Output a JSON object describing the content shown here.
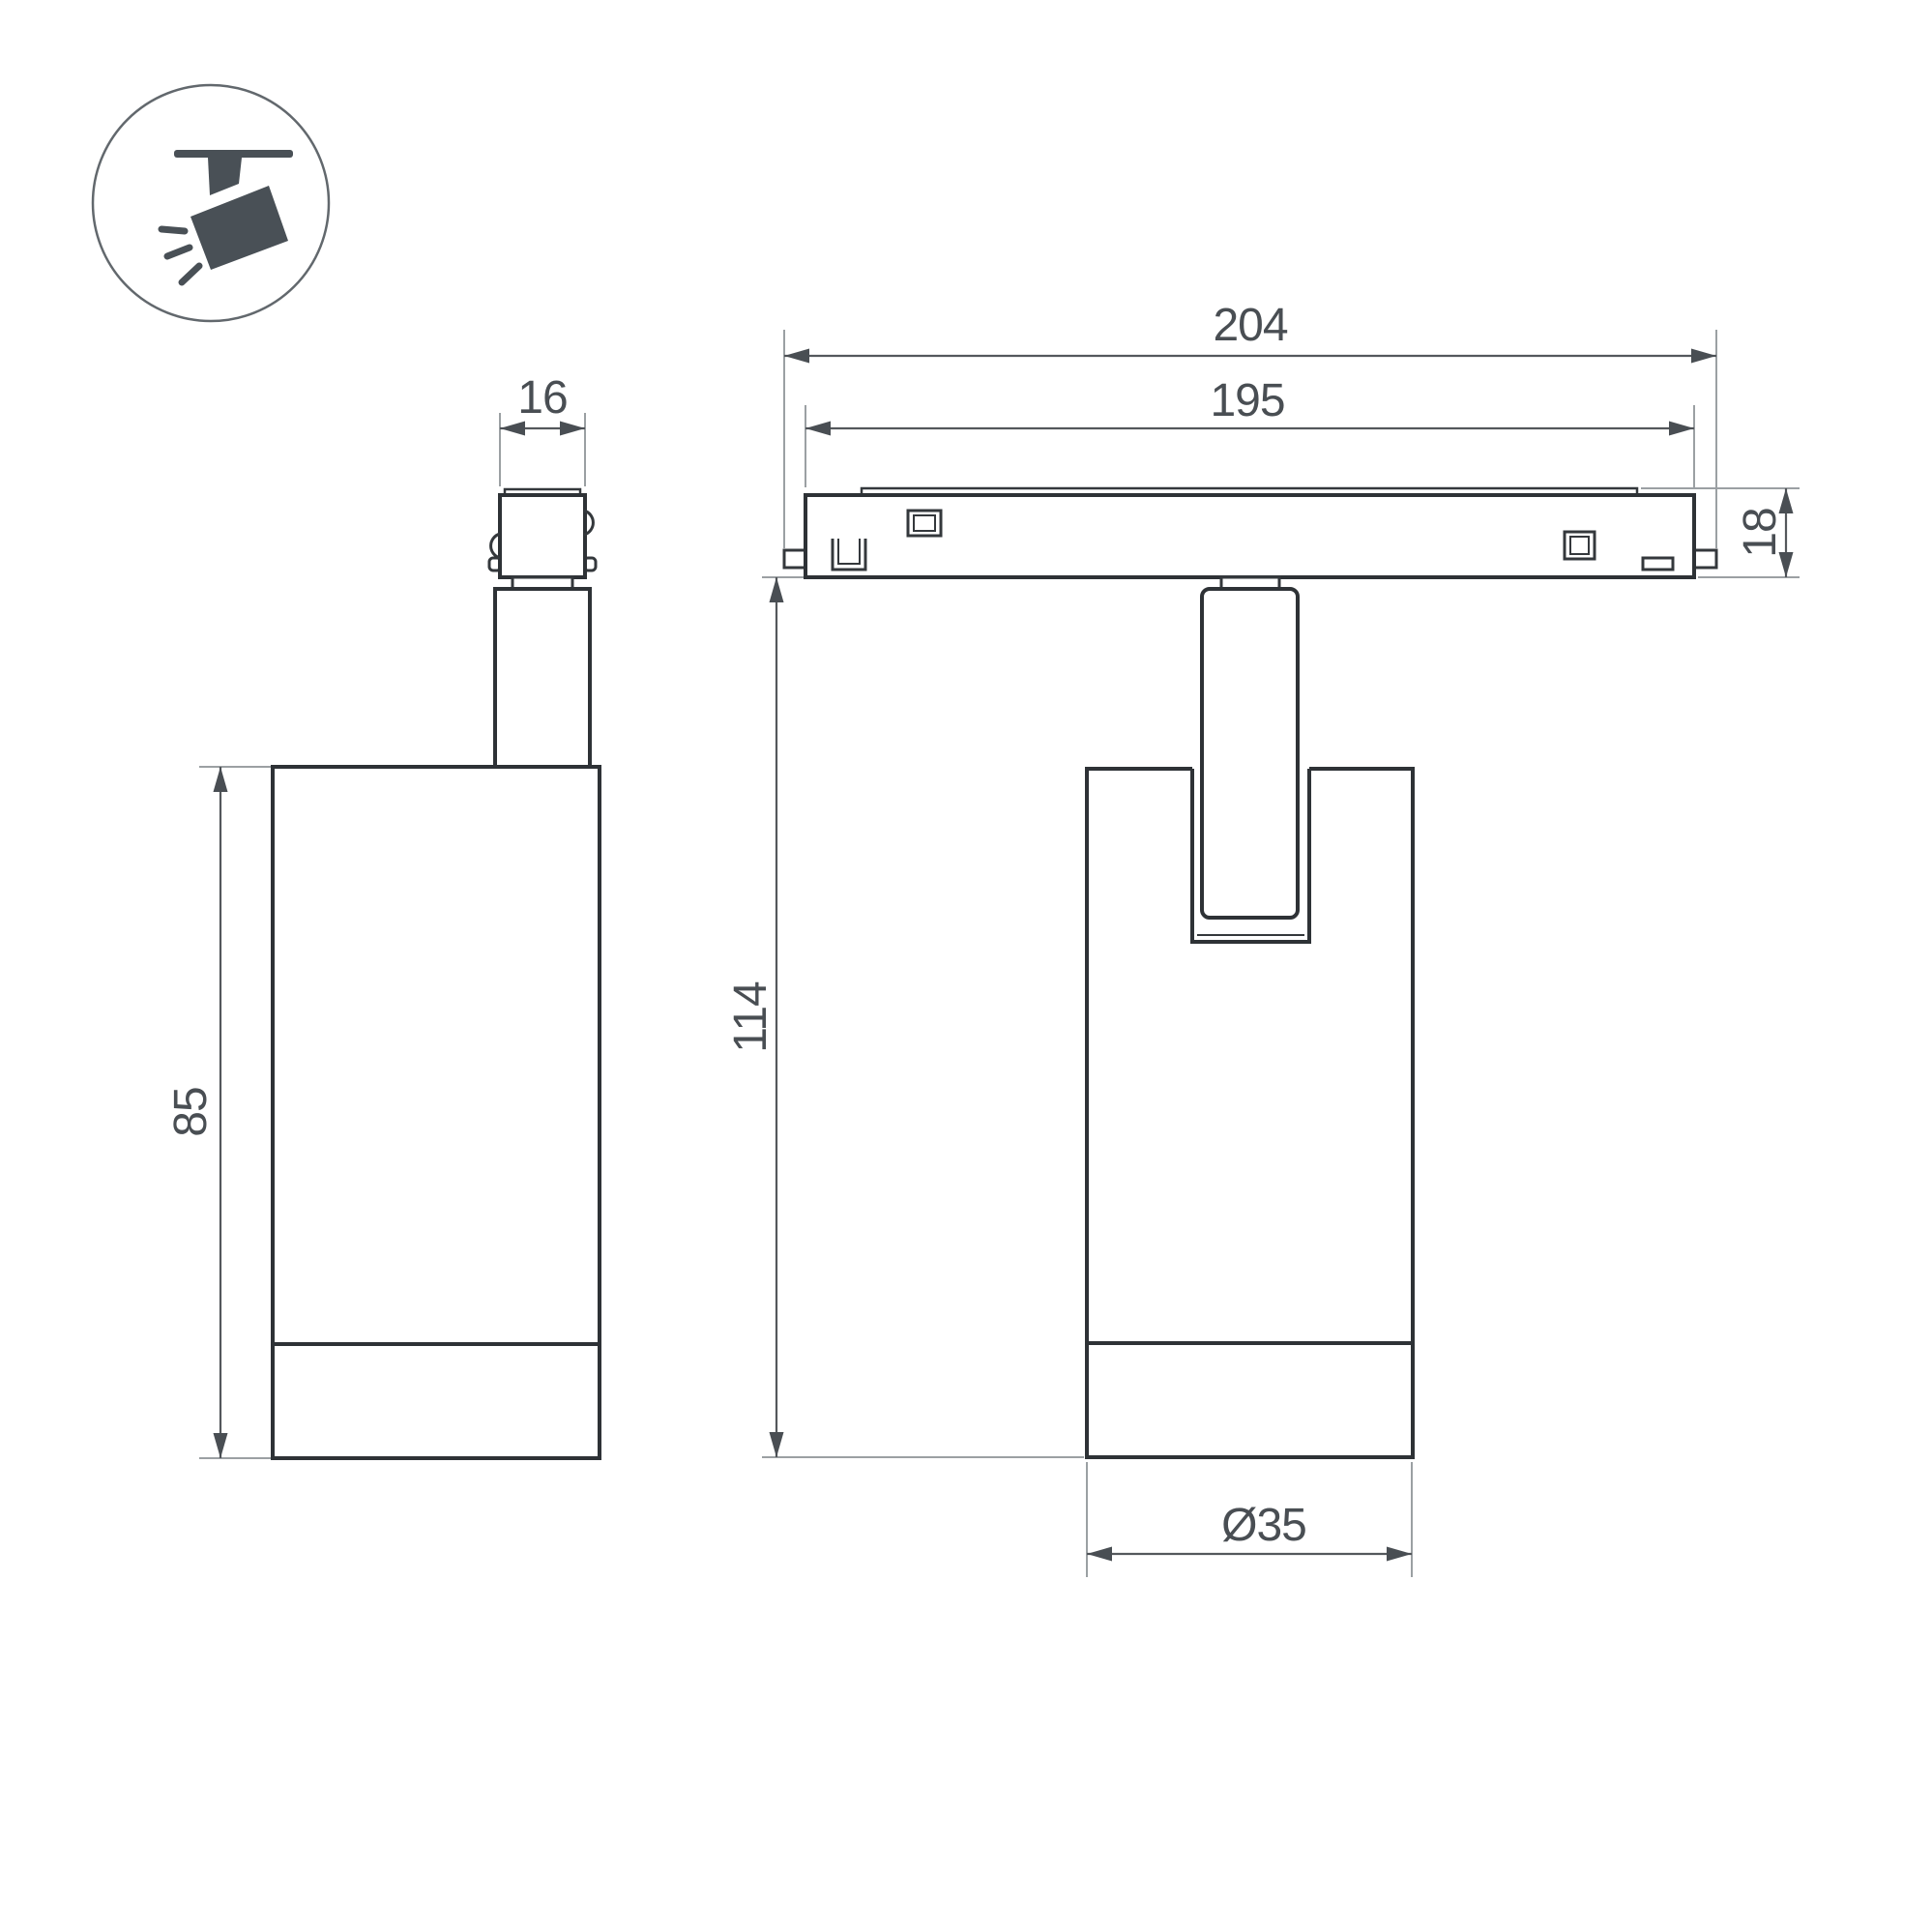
{
  "drawing": {
    "title": "Magnetic track spotlight dimensional drawing",
    "icon_name": "track-spotlight-icon"
  },
  "dimensions": {
    "adapter_width": "16",
    "overall_length": "204",
    "track_length": "195",
    "track_height": "18",
    "total_height": "114",
    "body_height": "85",
    "body_diameter": "Ø35"
  },
  "colors": {
    "outline": "#2e3236",
    "detail": "#34383c",
    "extension": "#9ba0a3",
    "dim_line": "#54585c",
    "dim_ink": "#494e53",
    "icon_fill": "#495056",
    "icon_ring": "#62686d",
    "background": "#ffffff"
  }
}
